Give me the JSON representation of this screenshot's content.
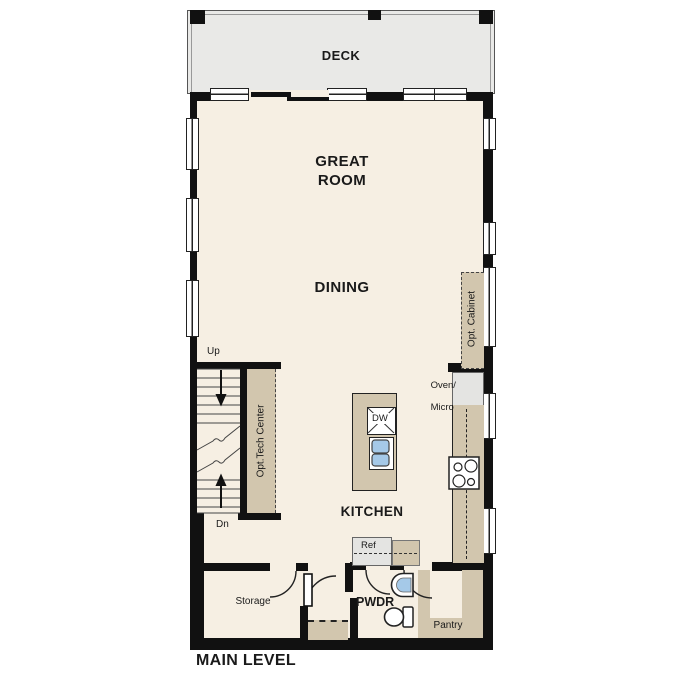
{
  "plan": {
    "title": "MAIN LEVEL",
    "rooms": {
      "deck": "DECK",
      "great_room": "GREAT ROOM",
      "dining": "DINING",
      "kitchen": "KITCHEN",
      "powder": "PWDR",
      "storage": "Storage",
      "pantry": "Pantry"
    },
    "stairs": {
      "up": "Up",
      "down": "Dn"
    },
    "labels": {
      "dishwasher": "DW",
      "refrigerator": "Ref",
      "oven_micro_line1": "Oven/",
      "oven_micro_line2": "Micro",
      "opt_tech_center": "Opt.Tech Center",
      "opt_cabinet": "Opt. Cabinet"
    },
    "colors": {
      "floor": "#f6efe3",
      "deck": "#e9e9e7",
      "cabinetry": "#d2c6ae",
      "appliance": "#e4e4e2",
      "sink_blue": "#a5c9e8",
      "wall": "#111111"
    }
  }
}
